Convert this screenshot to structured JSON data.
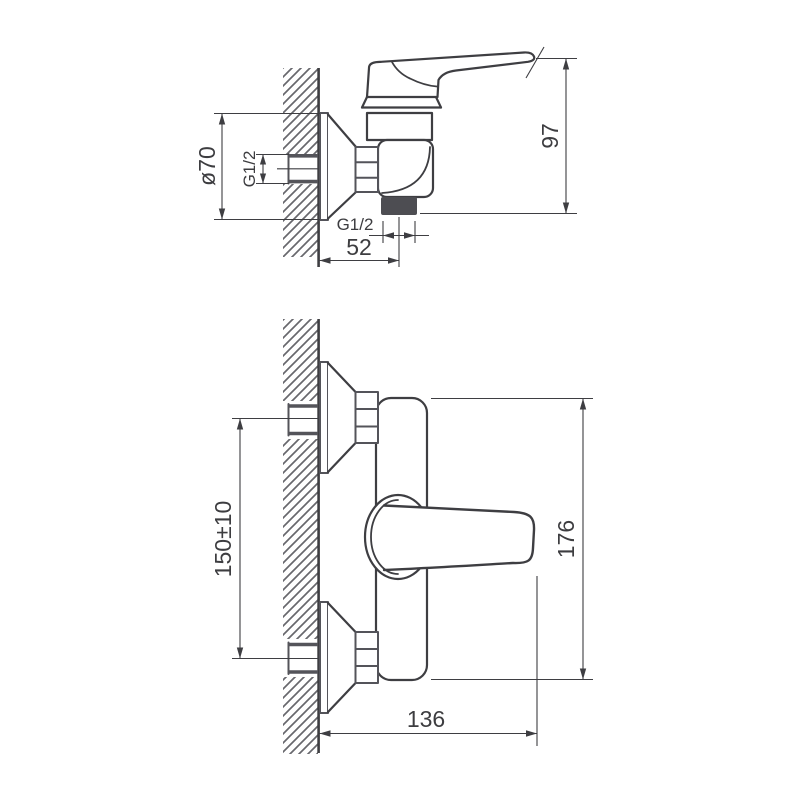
{
  "colors": {
    "background": "#ffffff",
    "outline": "#3e3e42",
    "hardware": "#54545a",
    "hatch": "#68686d",
    "outlet_fill": "#4d4d52",
    "dimension_text": "#3d3d40"
  },
  "side_view": {
    "dims": {
      "escutcheon_diameter": "ø70",
      "inlet_thread": "G1/2",
      "outlet_thread": "G1/2",
      "outlet_offset": "52",
      "height": "97"
    }
  },
  "front_view": {
    "dims": {
      "inlet_spacing": "150±10",
      "overall_height": "176",
      "overall_width": "136"
    }
  }
}
